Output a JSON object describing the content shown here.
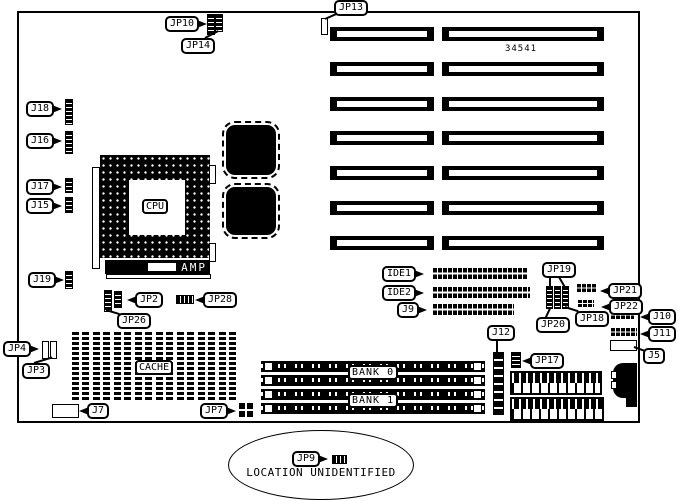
{
  "board": {
    "part_number": "34541",
    "note_label": "JP9",
    "note_text": "LOCATION UNIDENTIFIED"
  },
  "chips": {
    "cpu": "CPU",
    "amp": "AMP",
    "cache": "CACHE",
    "bank0": "BANK 0",
    "bank1": "BANK 1"
  },
  "labels": {
    "jp10": "JP10",
    "jp14": "JP14",
    "jp13": "JP13",
    "j18": "J18",
    "j16": "J16",
    "j17": "J17",
    "j15": "J15",
    "j19": "J19",
    "jp2": "JP2",
    "jp26": "JP26",
    "jp28": "JP28",
    "jp4": "JP4",
    "jp3": "JP3",
    "j7": "J7",
    "jp7": "JP7",
    "ide1": "IDE1",
    "ide2": "IDE2",
    "j9": "J9",
    "jp19": "JP19",
    "jp20": "JP20",
    "jp18": "JP18",
    "jp21": "JP21",
    "jp22": "JP22",
    "j10": "J10",
    "j11": "J11",
    "j5": "J5",
    "j12": "J12",
    "jp17": "JP17",
    "jp9": "JP9"
  }
}
